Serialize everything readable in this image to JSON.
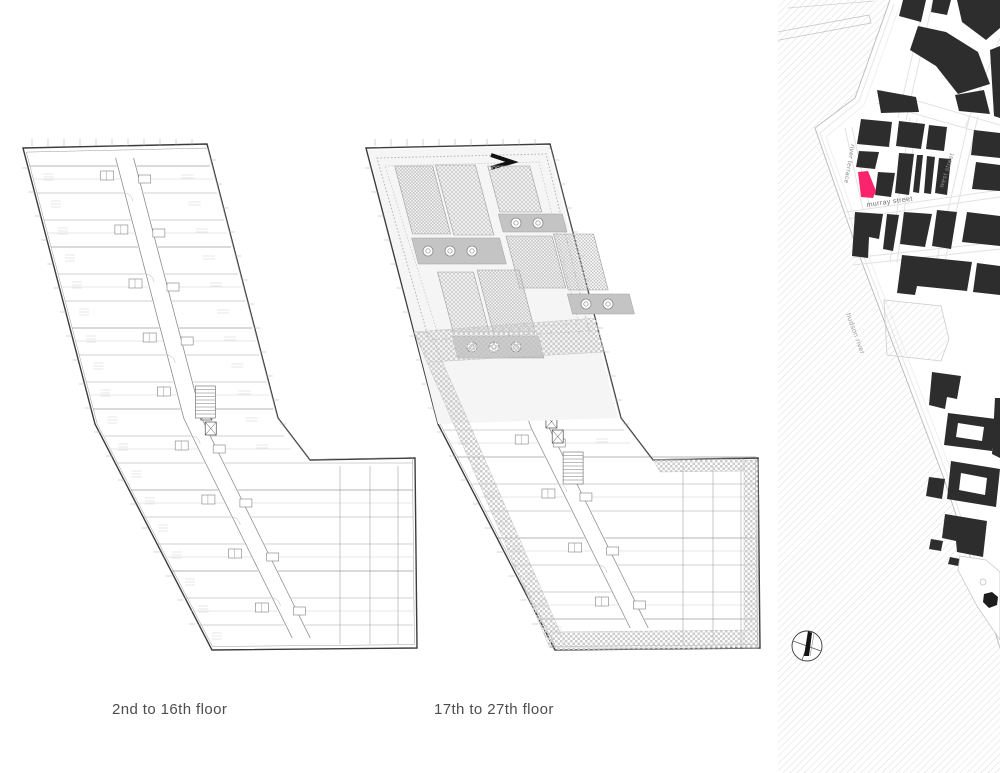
{
  "sheet": {
    "plans": [
      {
        "label": "2nd to 16th floor"
      },
      {
        "label": "17th to 27th floor"
      }
    ],
    "map": {
      "street_labels": {
        "river_terrace": "river terrace",
        "murray_street": "murray street",
        "west_street": "west street",
        "hudson_river": "hudson river"
      },
      "colors": {
        "highlight_pink": "#f9246b",
        "building_dark": "#2d2d2d",
        "water_hatch_line": "#dcdcdc"
      }
    }
  }
}
